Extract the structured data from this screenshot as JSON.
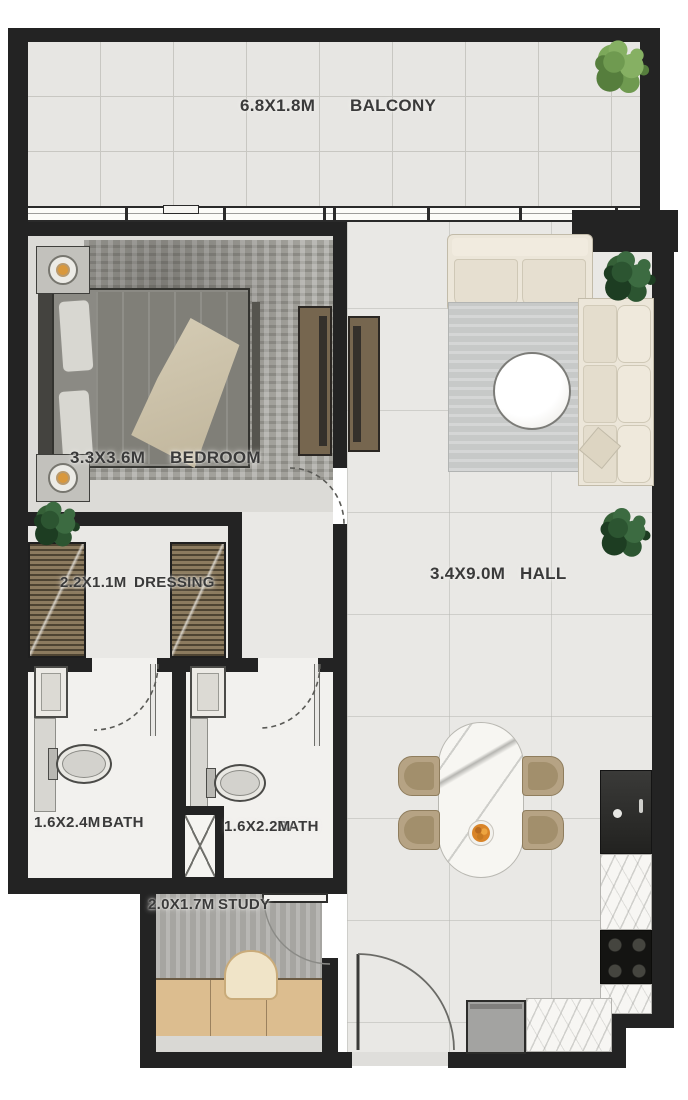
{
  "plan": {
    "type": "apartment-floor-plan",
    "rooms": {
      "balcony": {
        "name": "BALCONY",
        "dims": "6.8X1.8M"
      },
      "bedroom": {
        "name": "BEDROOM",
        "dims": "3.3X3.6M"
      },
      "dressing": {
        "name": "DRESSING",
        "dims": "2.2X1.1M"
      },
      "hall": {
        "name": "HALL",
        "dims": "3.4X9.0M"
      },
      "bath1": {
        "name": "BATH",
        "dims": "1.6X2.4M"
      },
      "bath2": {
        "name": "BATH",
        "dims": "1.6X2.2M"
      },
      "study": {
        "name": "STUDY",
        "dims": "2.0X1.7M"
      }
    },
    "colors": {
      "wall": "#232323",
      "label_text": "#3a3a3a",
      "fruit_accent": "#d98428",
      "plant_light": "#6f9a50",
      "plant_dark": "#2c5531",
      "wood_desk": "#dcbd8f",
      "chair_tan": "#b6a384",
      "sofa_cream": "#ece6d9"
    }
  }
}
